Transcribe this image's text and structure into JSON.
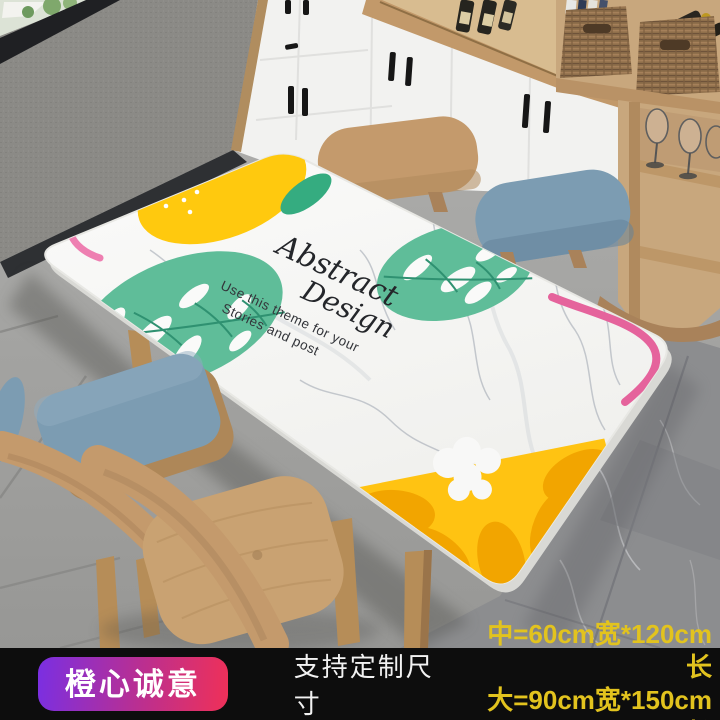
{
  "tablecloth": {
    "script_word1": "Abstract",
    "script_word2": "Design",
    "caption_line1": "Use this theme for your",
    "caption_line2": "Stories and post"
  },
  "footer": {
    "badge_label": "橙心诚意",
    "support_text": "支持定制尺寸",
    "sizes": [
      {
        "label": "中=60cm宽*120cm长"
      },
      {
        "label": "大=90cm宽*150cm长"
      }
    ]
  },
  "colors": {
    "bar_bg": "#0d0d0d",
    "badge_gradient_start": "#7a2fe2",
    "badge_gradient_end": "#ef3058",
    "badge_text": "#ffffff",
    "support_text": "#f2f2f2",
    "size_text": "#e2c31e",
    "lemon_yellow": "#ffc90e",
    "slice_yellow": "#ffc312",
    "slice_segment": "#f2a500",
    "leaf_teal": "#5fbd99",
    "pink_line": "#ee7fb1",
    "chair_blue": "#7c9cb2",
    "wood": "#c9a476",
    "marble_white": "#fafafa"
  }
}
